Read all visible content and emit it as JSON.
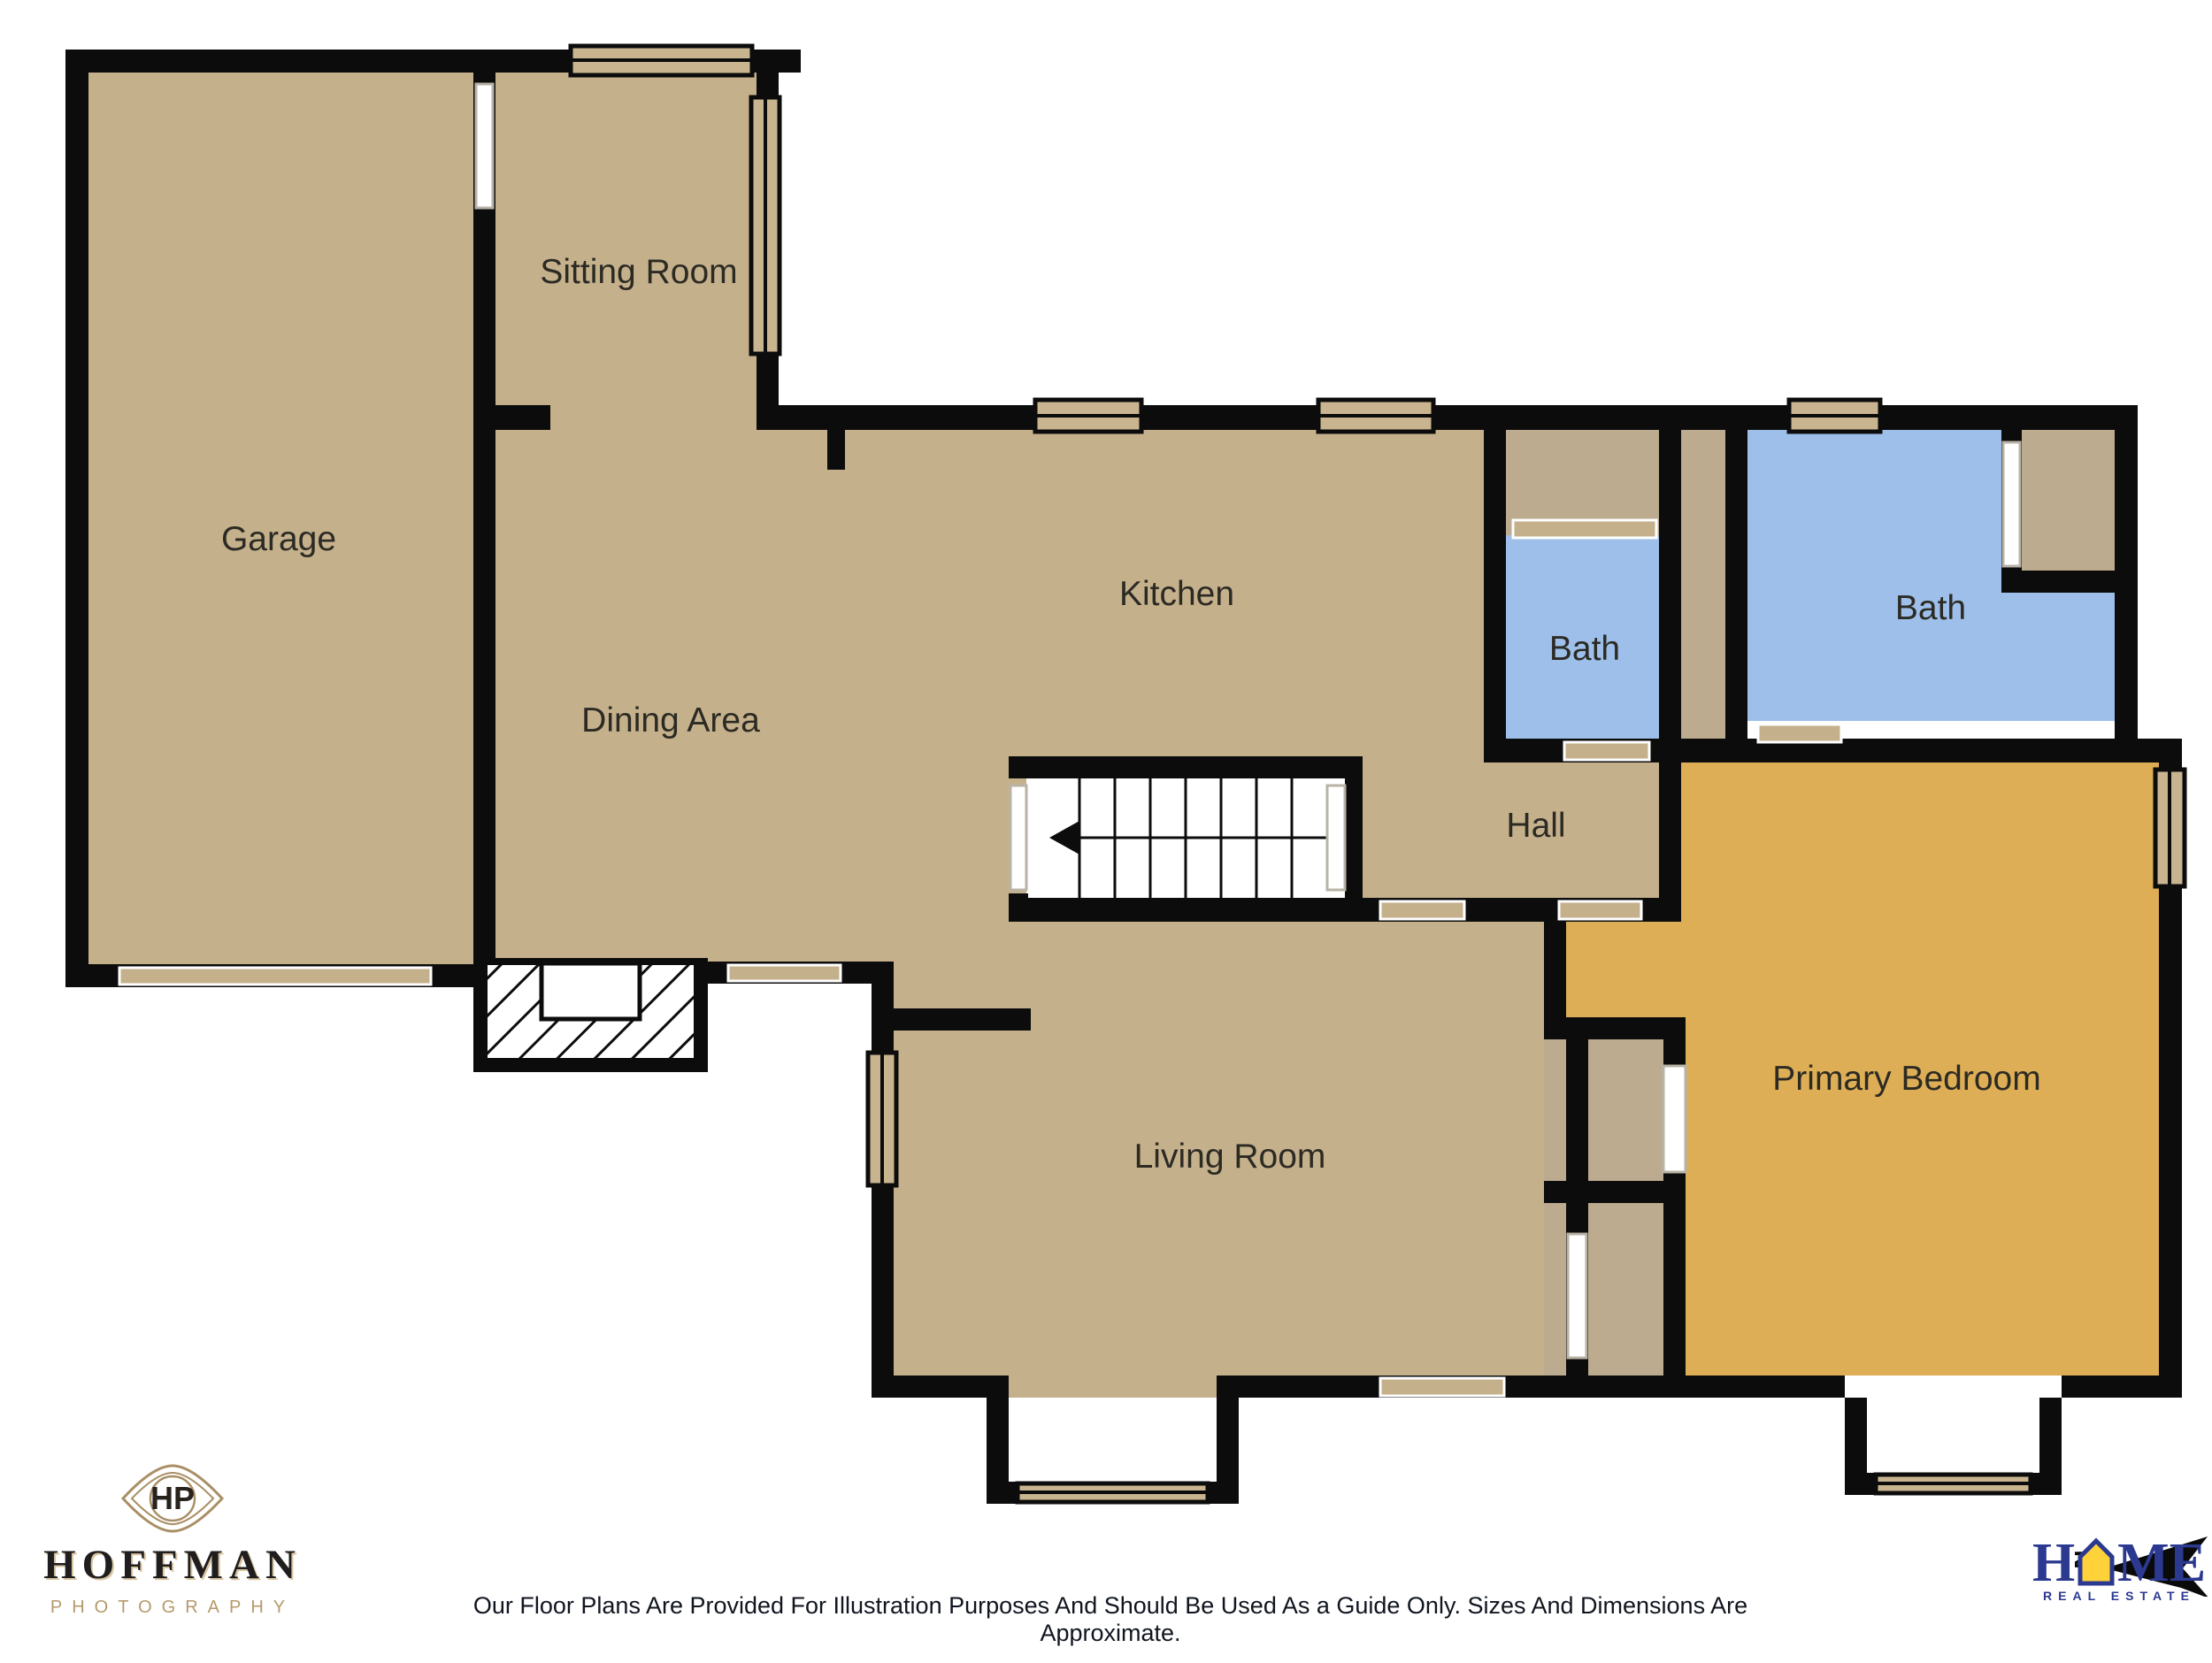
{
  "plan": {
    "rooms": {
      "garage": "Garage",
      "sitting_room": "Sitting Room",
      "kitchen": "Kitchen",
      "dining_area": "Dining Area",
      "bath_small": "Bath",
      "bath_large": "Bath",
      "hall": "Hall",
      "living_room": "Living Room",
      "primary_bedroom": "Primary Bedroom"
    },
    "colors": {
      "floor_tan": "#C5B08C",
      "closet_tan": "#BCAB8E",
      "bath_blue": "#9DBFE9",
      "bedroom_gold": "#DDAE55",
      "wall": "#0C0C0C",
      "window_fill": "#C9B490",
      "opening_white": "#FFFFFF"
    }
  },
  "footer": {
    "photographer": {
      "monogram": "HP",
      "name": "HOFFMAN",
      "tagline": "PHOTOGRAPHY"
    },
    "disclaimer": "Our Floor Plans Are Provided For Illustration Purposes And Should Be Used As a Guide Only. Sizes And Dimensions Are Approximate.",
    "brokerage": {
      "letter_h": "H",
      "letter_m": "M",
      "letter_e": "E",
      "sub": "REAL ESTATE",
      "north_label": "N"
    }
  }
}
